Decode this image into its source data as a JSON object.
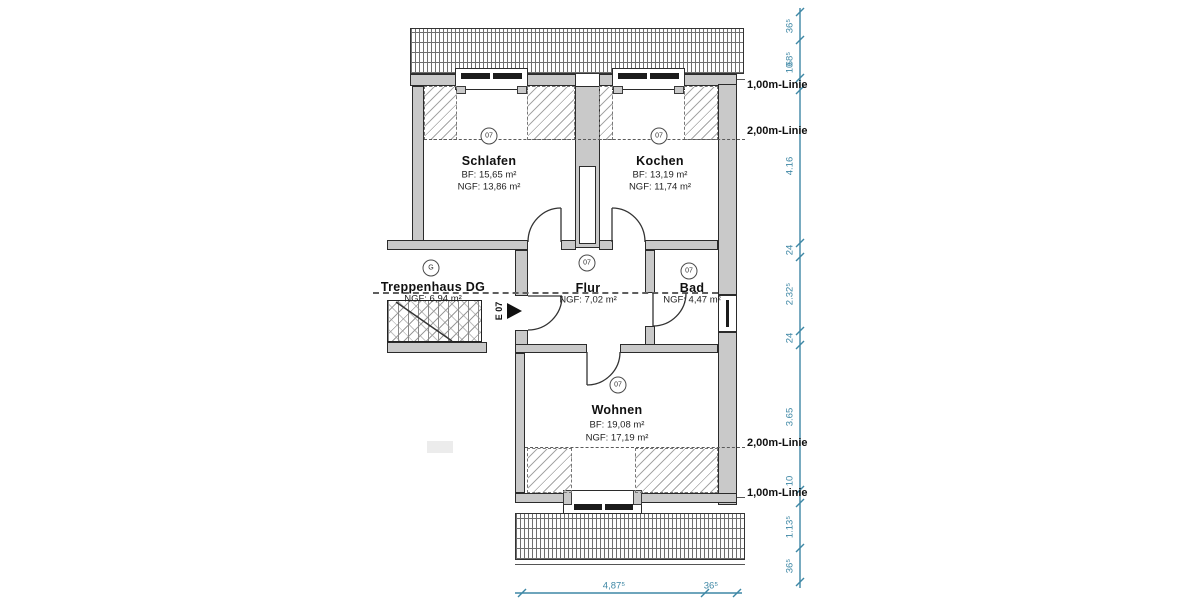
{
  "floorplan": {
    "rooms": [
      {
        "name": "Schlafen",
        "marker": "07",
        "area_bf": "BF: 15,65 m²",
        "area_ngf": "NGF: 13,86 m²"
      },
      {
        "name": "Kochen",
        "marker": "07",
        "area_bf": "BF: 13,19 m²",
        "area_ngf": "NGF: 11,74 m²"
      },
      {
        "name": "Flur",
        "marker": "07",
        "area_ngf": "NGF: 7,02 m²"
      },
      {
        "name": "Bad",
        "marker": "07",
        "area_ngf": "NGF: 4,47 m²"
      },
      {
        "name": "Wohnen",
        "marker": "07",
        "area_bf": "BF: 19,08 m²",
        "area_ngf": "NGF: 17,19 m²"
      },
      {
        "name": "Treppenhaus DG",
        "marker": "G",
        "area_ngf": "NGF: 6,94 m²"
      }
    ],
    "entrance": {
      "label": "E 07"
    },
    "height_lines": {
      "line_1m": "1,00m-Linie",
      "line_2m": "2,00m-Linie"
    },
    "dimensions": {
      "right": [
        "36⁵",
        "68⁵",
        "10",
        "4.16",
        "24",
        "2.32⁵",
        "24",
        "3.65",
        "10",
        "1.13⁵",
        "36⁵"
      ],
      "bottom": [
        "4,87⁵",
        "36⁵"
      ]
    },
    "colors": {
      "dimension_teal": "#3e87a5",
      "wall_gray": "#c9c9c9"
    }
  }
}
